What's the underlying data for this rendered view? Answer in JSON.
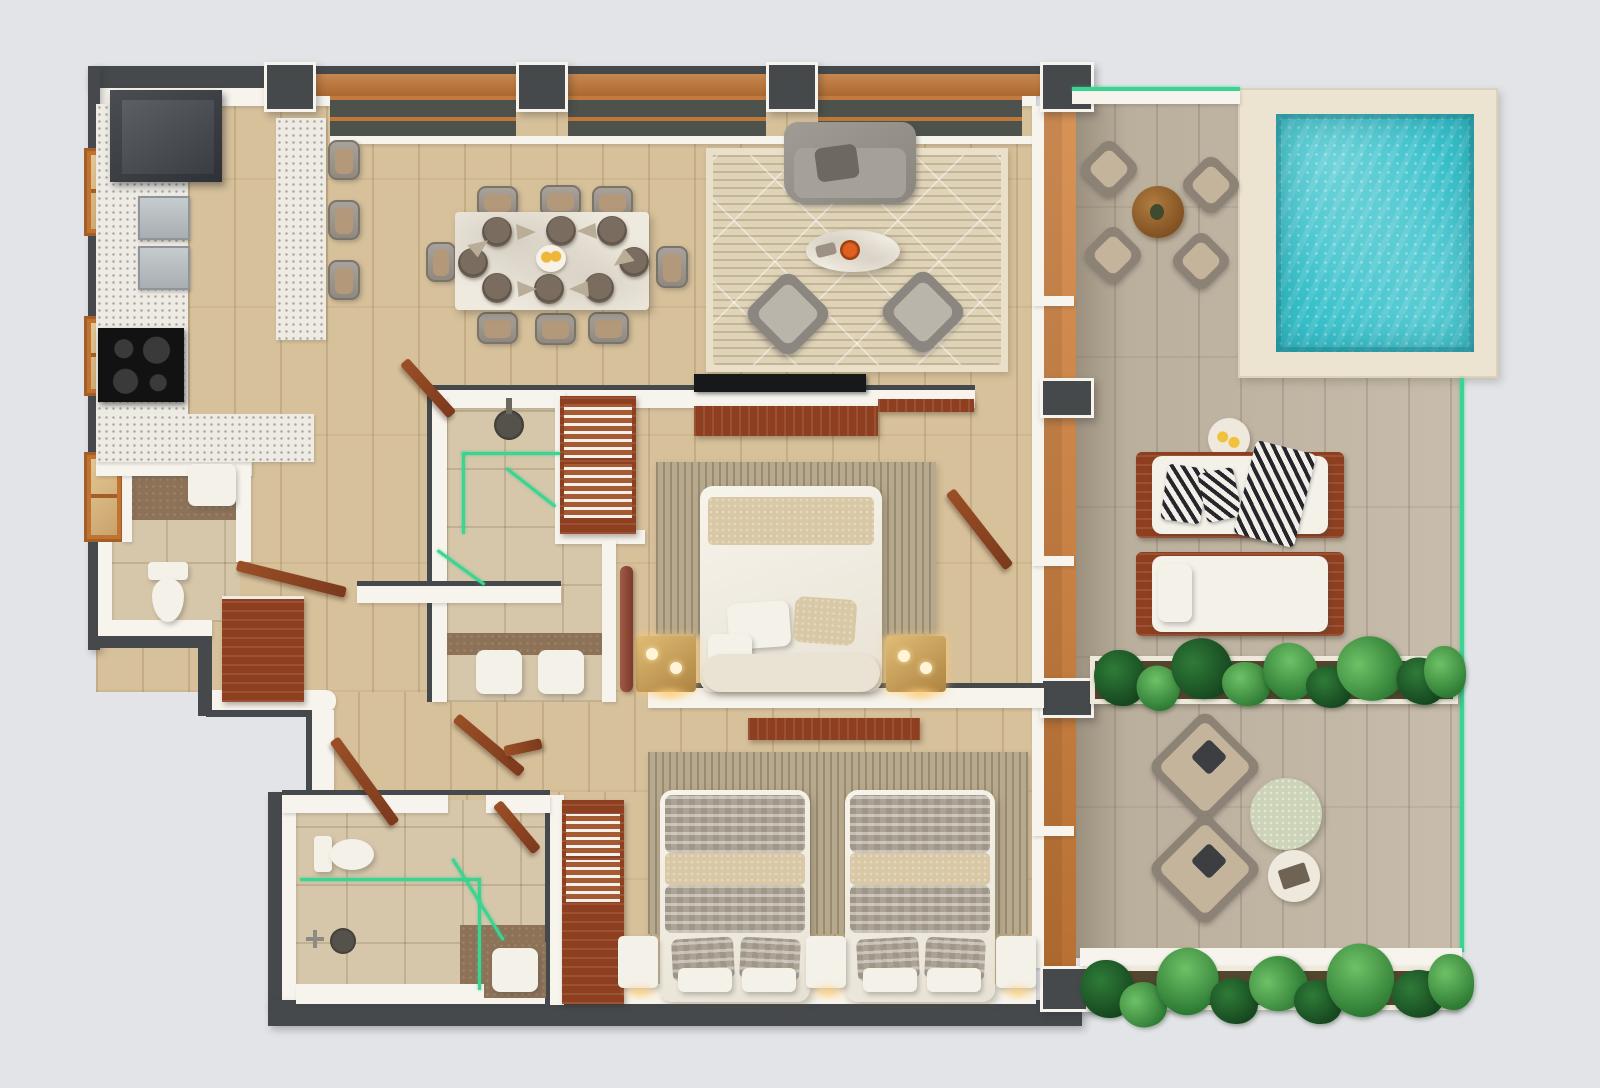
{
  "scene": {
    "kind": "3d-floor-plan-render",
    "view": "top-down",
    "description": "photoreal apartment floor plan with terrace and plunge pool",
    "visible_text": ""
  },
  "palette": {
    "bg": "#e2e4e7",
    "wall_dark": "#46494c",
    "wall_white": "#f7f4ed",
    "wood_orange": "#bf7434",
    "cabinet_wood": "#8e3f1f",
    "floor_wood": "#d7c19b",
    "floor_terrace": "#c2b7a6",
    "tile_bath": "#d7c7aa",
    "tile_brown": "#8d7258",
    "terrazzo": "#edebe4",
    "rug_living": "#e0d4b8",
    "rug_stripe": "#b7a98d",
    "marble": "#efeadf",
    "pool_water": "#38c1cb",
    "pool_deck": "#ece3d0",
    "glass_green": "#3bd491",
    "throw_beige": "#d8c8a6",
    "gold_lamp": "#c9a159",
    "tv_black": "#17181a"
  },
  "rooms": {
    "kitchen": {
      "label": "kitchen",
      "items": [
        "refrigerator",
        "terrazzo-counter",
        "steel-sink-modules",
        "cooktop",
        "island",
        "bar-stools"
      ]
    },
    "dining": {
      "label": "dining-area",
      "items": [
        "marble-dining-table",
        "dining-chairs",
        "place-settings",
        "centerpiece"
      ]
    },
    "living": {
      "label": "living-room",
      "items": [
        "area-rug",
        "sofa",
        "coffee-table",
        "armchairs",
        "tv",
        "tv-console"
      ]
    },
    "master_bedroom": {
      "label": "master-bedroom",
      "items": [
        "double-bed",
        "bench",
        "gold-table-lamps",
        "floor-lamp",
        "area-rug",
        "tv-console"
      ]
    },
    "master_bathroom": {
      "label": "master-bathroom",
      "items": [
        "walk-in-shower",
        "double-vanity",
        "glass-partition"
      ]
    },
    "walk_in_closet": {
      "label": "walk-in-closet",
      "items": [
        "wardrobe"
      ]
    },
    "powder_room": {
      "label": "powder-room",
      "items": [
        "toilet",
        "wash-basin"
      ]
    },
    "second_bedroom": {
      "label": "second-bedroom",
      "items": [
        "twin-bed",
        "twin-bed",
        "nightstand-lamps",
        "area-rug",
        "wardrobe",
        "tv-board"
      ]
    },
    "second_bathroom": {
      "label": "second-bathroom",
      "items": [
        "toilet",
        "walk-in-shower",
        "wash-basin",
        "glass-partition"
      ]
    },
    "hallway": {
      "label": "hallway",
      "items": [
        "open-wood-doors",
        "cabinet"
      ]
    },
    "terrace": {
      "label": "terrace",
      "items": [
        "bistro-table",
        "terrace-chairs",
        "sun-loungers",
        "drink-table",
        "lounge-chairs",
        "stone-table",
        "tray-table",
        "planters"
      ]
    },
    "pool": {
      "label": "plunge-pool",
      "items": [
        "pool-water",
        "pool-deck"
      ]
    }
  },
  "counts": {
    "dining_chairs": 8,
    "place_settings": 8,
    "bar_stools": 3,
    "twin_beds": 2,
    "sun_loungers": 2,
    "terrace_bistro_chairs": 4,
    "lounge_chairs": 2,
    "planter_rows": 2,
    "bathrooms": 3,
    "windows_left_wall": 3,
    "structural_pillars": 8
  }
}
